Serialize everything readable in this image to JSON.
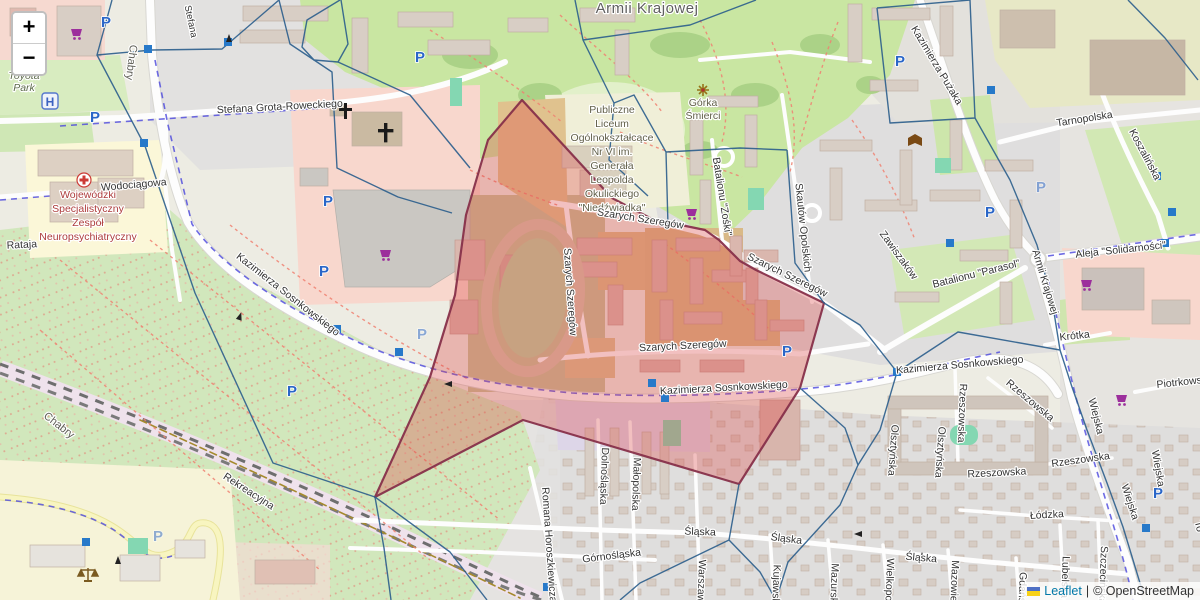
{
  "controls": {
    "zoom_in": "+",
    "zoom_out": "−"
  },
  "attribution": {
    "flag_icon": "ukraine-flag-icon",
    "leaflet_link": "Leaflet",
    "separator": "|",
    "osm_text": "© OpenStreetMap"
  },
  "icons": {
    "parking": "P",
    "helipad": "H"
  },
  "colors": {
    "highlight_fill": "#de4646",
    "highlight_border": "#87304a",
    "boundary_blue": "#2b5e8c",
    "parking_blue": "#2a66c8",
    "shop_purple": "#9c2f9c",
    "hospital_red": "#c03a3a",
    "leaflet_link_blue": "#0078a8",
    "park_green": "#c9e6a2",
    "residential_gray": "#e0dfdf",
    "retail_pink": "#f8d7cd"
  },
  "labels": {
    "district_armii_krajowej": "Armii Krajowej",
    "district_chabry_1": "Chabry",
    "district_chabry_2": "Chabry",
    "toyota_park": [
      "Toyota",
      "Park"
    ],
    "hospital": [
      "Wojewódzki",
      "Specjalistyczny",
      "Zespół",
      "Neuropsychiatryczny"
    ],
    "school": [
      "Publiczne",
      "Liceum",
      "Ogólnokształcące",
      "Nr VI im.",
      "Generała",
      "Leopolda",
      "Okulickiego",
      "\"Niedźwiadka\""
    ],
    "gorka_smierci": [
      "Górka",
      "Śmierci"
    ],
    "st_roweckiego": "Stefana Grota-Roweckiego",
    "st_stefana_partial": "Stefana",
    "st_wodociagowa": "Wodociągowa",
    "st_rataja": "Rataja",
    "st_rekreacyjna": "Rekreacyjna",
    "st_sosnkowskiego_nw": "Kazimierza Sosnkowskiego",
    "st_sosnkowskiego_mid": "Kazimierza Sosnkowskiego",
    "st_sosnkowskiego_e": "Kazimierza Sosnkowskiego",
    "st_szarych_n": "Szarych Szeregów",
    "st_szarych_ne": "Szarych Szeregów",
    "st_szarych_w": "Szarych Szeregów",
    "st_szarych_s": "Szarych Szeregów",
    "st_puzaka": "Kazimierza Pużaka",
    "st_tarnopolska": "Tarnopolska",
    "st_koszalinska": "Koszalińska",
    "st_solidarnosci": "Aleja \"Solidarności\"",
    "st_armii_krajowej_rd": "Armii Krajowej",
    "st_parasol": "Batalionu \"Parasol\"",
    "st_zawiszakow": "Zawiszaków",
    "st_zoski": "Batalionu \"Zośki\"",
    "st_skautow": "Skautów Opolskich",
    "st_krotka": "Krótka",
    "st_piotrkowska": "Piotrkowska",
    "st_wiejska_1": "Wiejska",
    "st_wiejska_2": "Wiejska",
    "st_wiejska_3": "Wiejska",
    "st_rzeszowska_v": "Rzeszowska",
    "st_rzeszowska_d": "Rzeszowska",
    "st_rzeszowska_h": "Rzeszowska",
    "st_rzeszowska_h2": "Rzeszowska",
    "st_lodzka": "Łódzka",
    "st_olsztynska_1": "Olsztyńska",
    "st_olsztynska_2": "Olsztyńska",
    "st_slaska_1": "Śląska",
    "st_slaska_2": "Śląska",
    "st_slaska_3": "Śląska",
    "st_gornoslaska": "Górnośląska",
    "st_dolnoslaska": "Dolnośląska",
    "st_malopolska": "Małopolska",
    "st_horoszkiewicza": "Romana Horoszkiewicza",
    "st_warszawska": "Warszawska",
    "st_kujawska": "Kujawska",
    "st_mazurska": "Mazurska",
    "st_wielkopolska": "Wielkopolska",
    "st_mazowiecka": "Mazowiecka",
    "st_gdanska": "Gdańska",
    "st_lubelska": "Lubelska",
    "st_szczecinska": "Szczecińska",
    "st_torunska_fragment": "To"
  }
}
